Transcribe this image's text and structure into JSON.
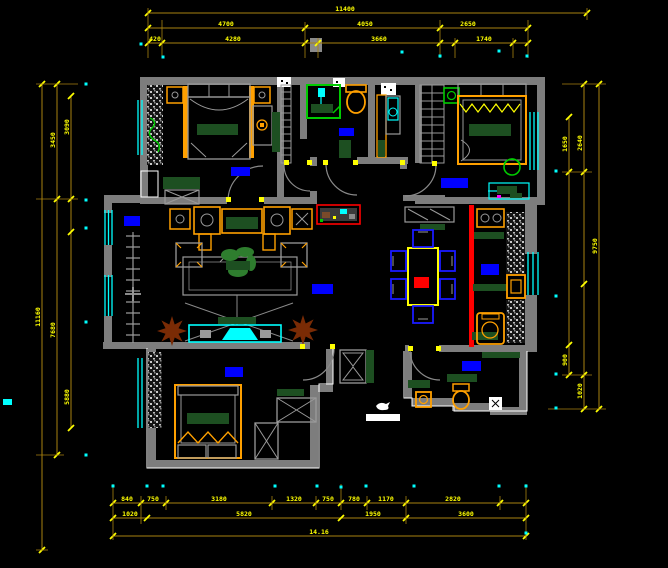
{
  "title": "apartment-floor-plan-cad-drawing",
  "colors": {
    "background": "#000000",
    "wall": "#7d7d7d",
    "furniture_gray": "#9a9a9a",
    "dim_line": "#a8820f",
    "dim_text": "#ffff00",
    "tick": "#ffff00",
    "window": "#00ffff",
    "label_block": "#0000ff",
    "accent_red": "#ff0000",
    "furniture_orange": "#ffa000",
    "dark_green": "#1d4f21",
    "bright_green": "#00cc00",
    "plant_brown": "#7a2b05",
    "chair_blue": "#1a1aff",
    "magenta": "#ff00ff",
    "white": "#ffffff"
  },
  "dimensions": {
    "top": [
      {
        "y": 13,
        "x1": 148,
        "x2": 587,
        "ticks": [
          148,
          587
        ],
        "labels": [
          {
            "text": "11400",
            "x": 345
          }
        ]
      },
      {
        "y": 28,
        "x1": 148,
        "x2": 528,
        "ticks": [
          148,
          305,
          440,
          528
        ],
        "labels": [
          {
            "text": "4700",
            "x": 226
          },
          {
            "text": "4050",
            "x": 365
          },
          {
            "text": "2650",
            "x": 468
          }
        ]
      },
      {
        "y": 43,
        "x1": 148,
        "x2": 528,
        "ticks": [
          148,
          162,
          305,
          318,
          440,
          455,
          513,
          528
        ],
        "labels": [
          {
            "text": "420",
            "x": 155
          },
          {
            "text": "4280",
            "x": 233
          },
          {
            "text": "3660",
            "x": 379
          },
          {
            "text": "1740",
            "x": 484
          }
        ]
      }
    ],
    "bottom": [
      {
        "y": 503,
        "x1": 113,
        "x2": 526,
        "ticks": [
          113,
          141,
          166,
          272,
          316,
          341,
          367,
          406,
          500,
          526
        ],
        "labels": [
          {
            "text": "840",
            "x": 127
          },
          {
            "text": "750",
            "x": 153
          },
          {
            "text": "3180",
            "x": 219
          },
          {
            "text": "1320",
            "x": 294
          },
          {
            "text": "750",
            "x": 328
          },
          {
            "text": "780",
            "x": 354
          },
          {
            "text": "1170",
            "x": 386
          },
          {
            "text": "2820",
            "x": 453
          }
        ]
      },
      {
        "y": 518,
        "x1": 113,
        "x2": 526,
        "ticks": [
          113,
          147,
          341,
          406,
          526
        ],
        "labels": [
          {
            "text": "1020",
            "x": 130
          },
          {
            "text": "5820",
            "x": 244
          },
          {
            "text": "1950",
            "x": 373
          },
          {
            "text": "3600",
            "x": 466
          }
        ]
      },
      {
        "y": 536,
        "x1": 113,
        "x2": 526,
        "ticks": [
          113,
          526
        ],
        "labels": [
          {
            "text": "14.16",
            "x": 319
          }
        ]
      }
    ],
    "left": [
      {
        "x": 42,
        "y1": 84,
        "y2": 550,
        "ticks": [
          84,
          550
        ],
        "labels": [
          {
            "text": "11160",
            "y": 317
          }
        ]
      },
      {
        "x": 57,
        "y1": 84,
        "y2": 455,
        "ticks": [
          84,
          199,
          455
        ],
        "labels": [
          {
            "text": "3450",
            "y": 140
          },
          {
            "text": "7680",
            "y": 330
          }
        ]
      },
      {
        "x": 71,
        "y1": 96,
        "y2": 428,
        "ticks": [
          96,
          199,
          232,
          428
        ],
        "labels": [
          {
            "text": "3090",
            "y": 127
          },
          {
            "text": "5880",
            "y": 397
          }
        ]
      }
    ],
    "right": [
      {
        "x": 569,
        "y1": 117,
        "y2": 375,
        "ticks": [
          117,
          172,
          345,
          375
        ],
        "labels": [
          {
            "text": "1650",
            "y": 144
          },
          {
            "text": "900",
            "y": 360
          }
        ]
      },
      {
        "x": 584,
        "y1": 84,
        "y2": 409,
        "ticks": [
          84,
          172,
          284,
          375,
          409
        ],
        "labels": [
          {
            "text": "2640",
            "y": 143
          },
          {
            "text": "1020",
            "y": 391
          }
        ]
      },
      {
        "x": 599,
        "y1": 84,
        "y2": 409,
        "ticks": [
          84,
          409
        ],
        "labels": [
          {
            "text": "9750",
            "y": 246
          }
        ]
      }
    ],
    "top_extensions": [
      [
        148,
        8,
        58
      ],
      [
        162,
        20,
        58
      ],
      [
        305,
        22,
        58
      ],
      [
        318,
        38,
        58
      ],
      [
        440,
        20,
        58
      ],
      [
        455,
        38,
        58
      ],
      [
        513,
        38,
        58
      ],
      [
        528,
        20,
        58
      ],
      [
        587,
        8,
        20
      ]
    ],
    "bottom_extensions": [
      [
        113,
        484,
        540
      ],
      [
        141,
        496,
        524
      ],
      [
        166,
        496,
        510
      ],
      [
        272,
        496,
        510
      ],
      [
        316,
        496,
        510
      ],
      [
        341,
        484,
        510
      ],
      [
        367,
        496,
        510
      ],
      [
        406,
        496,
        524
      ],
      [
        500,
        496,
        510
      ],
      [
        526,
        484,
        540
      ]
    ],
    "left_extensions": [
      [
        84,
        36,
        78
      ],
      [
        199,
        36,
        78
      ],
      [
        455,
        36,
        64
      ],
      [
        550,
        36,
        48
      ]
    ],
    "right_extensions": [
      [
        84,
        562,
        606
      ],
      [
        172,
        562,
        592
      ],
      [
        375,
        562,
        592
      ],
      [
        409,
        548,
        606
      ]
    ]
  },
  "room_label_blocks": [
    {
      "name": "bedroom-1",
      "x": 231,
      "y": 167,
      "w": 19,
      "h": 9
    },
    {
      "name": "living-room-left",
      "x": 124,
      "y": 216,
      "w": 16,
      "h": 10
    },
    {
      "name": "living-room-center",
      "x": 312,
      "y": 284,
      "w": 21,
      "h": 10
    },
    {
      "name": "bathroom-1",
      "x": 339,
      "y": 128,
      "w": 15,
      "h": 8
    },
    {
      "name": "bedroom-2",
      "x": 441,
      "y": 178,
      "w": 27,
      "h": 10
    },
    {
      "name": "kitchen",
      "x": 481,
      "y": 264,
      "w": 18,
      "h": 11
    },
    {
      "name": "bathroom-2",
      "x": 462,
      "y": 361,
      "w": 19,
      "h": 10
    },
    {
      "name": "bedroom-3",
      "x": 225,
      "y": 367,
      "w": 18,
      "h": 10
    }
  ],
  "cyan_dots": [
    [
      141,
      44
    ],
    [
      163,
      57
    ],
    [
      402,
      52
    ],
    [
      440,
      56
    ],
    [
      499,
      51
    ],
    [
      527,
      56
    ],
    [
      113,
      486
    ],
    [
      147,
      486
    ],
    [
      163,
      486
    ],
    [
      275,
      486
    ],
    [
      317,
      486
    ],
    [
      341,
      487
    ],
    [
      366,
      486
    ],
    [
      414,
      486
    ],
    [
      499,
      486
    ],
    [
      526,
      486
    ],
    [
      526,
      533
    ],
    [
      86,
      84
    ],
    [
      86,
      200
    ],
    [
      86,
      228
    ],
    [
      86,
      322
    ],
    [
      86,
      455
    ],
    [
      556,
      171
    ],
    [
      556,
      296
    ],
    [
      556,
      374
    ],
    [
      556,
      408
    ]
  ],
  "cyan_rects": [
    {
      "x": 3,
      "y": 399,
      "w": 9,
      "h": 6
    }
  ]
}
